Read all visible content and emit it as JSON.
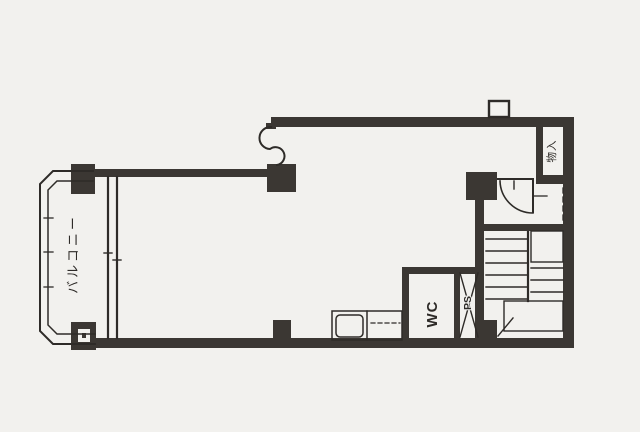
{
  "plan": {
    "title_hint": "apartment floor plan (scanned drawing)",
    "labels": {
      "balcony": "バルコニー",
      "wc": "WC",
      "ps": "PS",
      "storage": "物入"
    },
    "colors": {
      "paper": "#f2f1ee",
      "ink": "#2e2b28",
      "wall": "#3b3733"
    }
  }
}
